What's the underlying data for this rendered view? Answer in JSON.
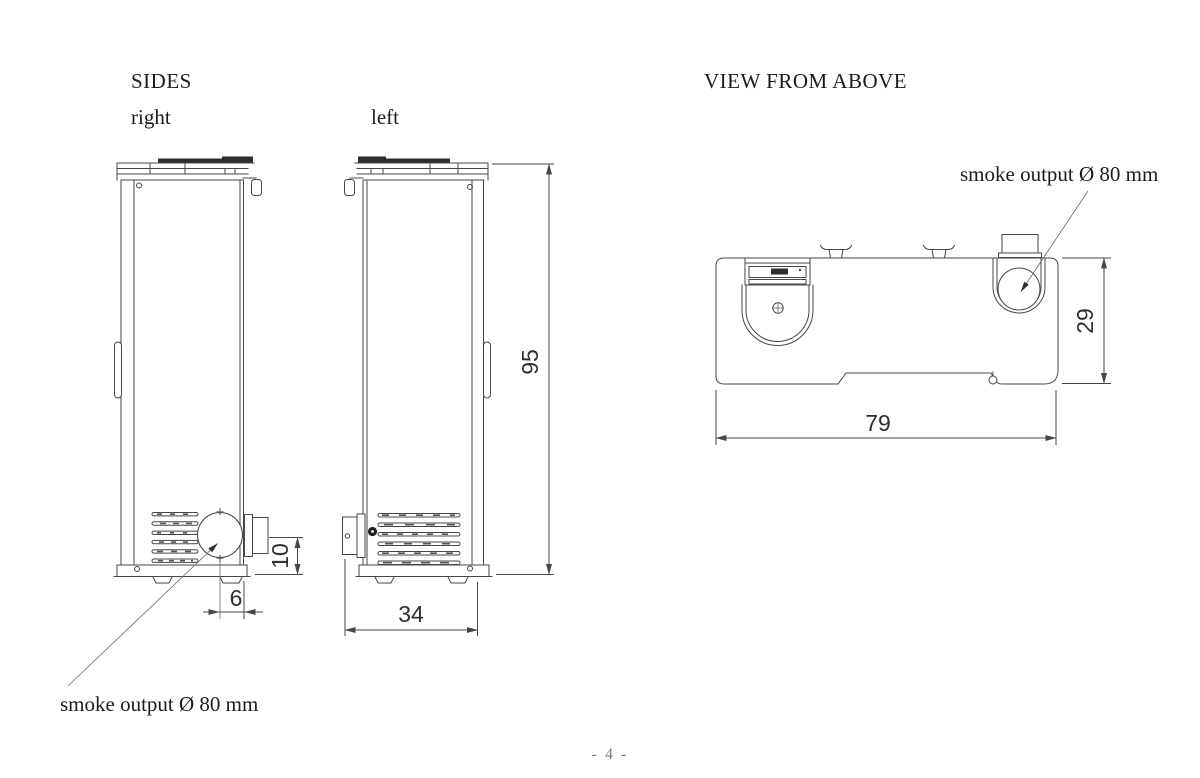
{
  "page": {
    "number": "- 4 -"
  },
  "sides_section": {
    "title": "SIDES",
    "right_view_label": "right",
    "left_view_label": "left",
    "smoke_output_annotation": "smoke output Ø 80 mm",
    "dimensions": {
      "height": "95",
      "depth": "34",
      "outlet_height": "10",
      "outlet_offset": "6"
    }
  },
  "top_view_section": {
    "title": "VIEW FROM ABOVE",
    "smoke_output_annotation": "smoke output Ø 80 mm",
    "dimensions": {
      "width": "79",
      "depth": "29"
    }
  },
  "colors": {
    "background": "#ffffff",
    "line": "#474747",
    "text": "#1b1b1b",
    "dimension_text": "#2f2f2f",
    "page_number": "#7d7d7d"
  }
}
